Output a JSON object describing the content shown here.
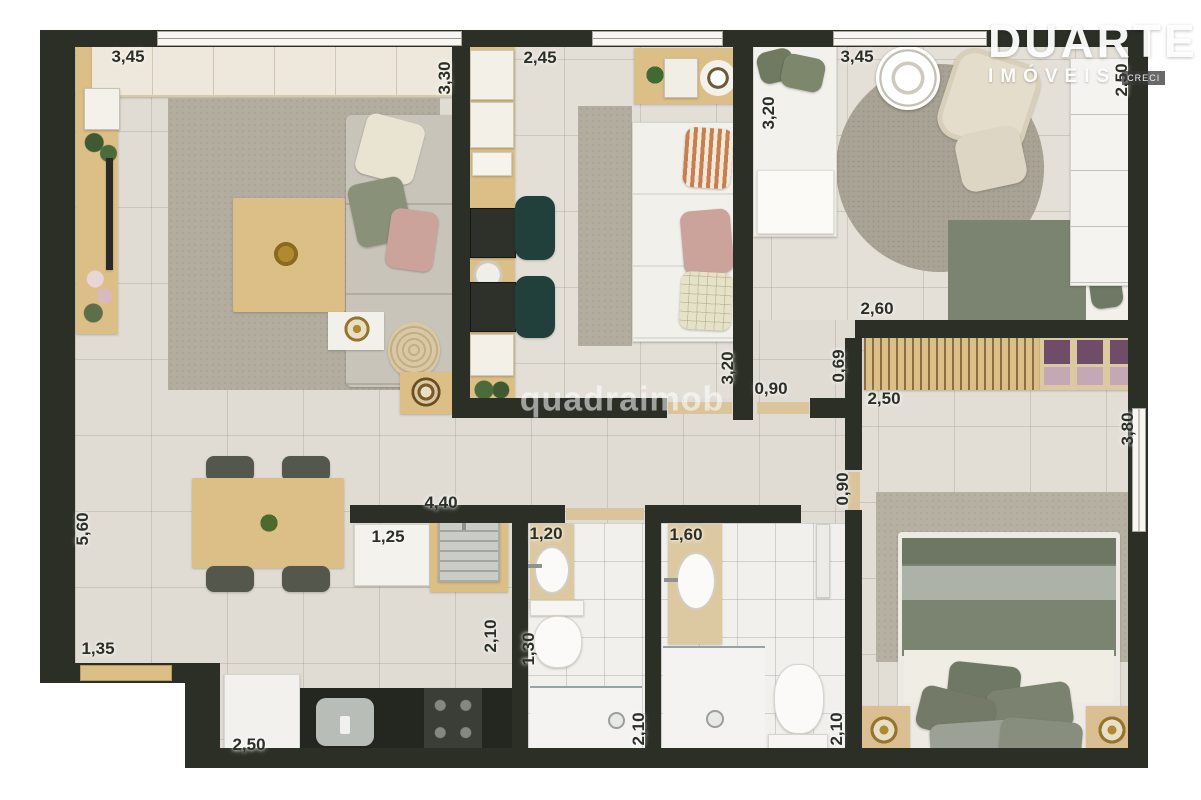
{
  "watermark": "quadraimob",
  "logo": {
    "name": "DUARTE",
    "subtitle": "IMÓVEIS",
    "badge": "CRECI"
  },
  "labels": [
    {
      "t": "3,45",
      "x": 128,
      "y": 57,
      "v": false
    },
    {
      "t": "3,30",
      "x": 445,
      "y": 78,
      "v": true
    },
    {
      "t": "2,45",
      "x": 540,
      "y": 58,
      "v": false
    },
    {
      "t": "3,20",
      "x": 769,
      "y": 113,
      "v": true
    },
    {
      "t": "3,45",
      "x": 857,
      "y": 57,
      "v": false
    },
    {
      "t": "2,50",
      "x": 1122,
      "y": 80,
      "v": true
    },
    {
      "t": "3,20",
      "x": 728,
      "y": 368,
      "v": true
    },
    {
      "t": "2,60",
      "x": 877,
      "y": 309,
      "v": false
    },
    {
      "t": "0,69",
      "x": 839,
      "y": 366,
      "v": true
    },
    {
      "t": "0,90",
      "x": 771,
      "y": 389,
      "v": false
    },
    {
      "t": "2,50",
      "x": 884,
      "y": 399,
      "v": false
    },
    {
      "t": "3,80",
      "x": 1128,
      "y": 429,
      "v": true
    },
    {
      "t": "0,90",
      "x": 843,
      "y": 489,
      "v": true
    },
    {
      "t": "5,60",
      "x": 83,
      "y": 529,
      "v": true
    },
    {
      "t": "4,40",
      "x": 441,
      "y": 503,
      "v": false
    },
    {
      "t": "1,25",
      "x": 388,
      "y": 537,
      "v": false
    },
    {
      "t": "1,20",
      "x": 546,
      "y": 534,
      "v": false
    },
    {
      "t": "1,60",
      "x": 686,
      "y": 535,
      "v": false
    },
    {
      "t": "2,10",
      "x": 491,
      "y": 636,
      "v": true
    },
    {
      "t": "1,30",
      "x": 529,
      "y": 649,
      "v": true
    },
    {
      "t": "1,35",
      "x": 98,
      "y": 649,
      "v": false
    },
    {
      "t": "2,50",
      "x": 249,
      "y": 745,
      "v": false
    },
    {
      "t": "2,10",
      "x": 639,
      "y": 729,
      "v": true
    },
    {
      "t": "2,10",
      "x": 837,
      "y": 729,
      "v": true
    }
  ],
  "colors": {
    "wall": "#2b2f25",
    "floor": "#e0dcd4",
    "bathfloor": "#f1f0ed",
    "wood": "#dcbf87",
    "tan": "#dcc9a2",
    "rug": "#b3ada0",
    "sofa": "#c9c4ba",
    "greenbed": "#7b8470",
    "sage": "#acb2a7",
    "pink": "#cba39a",
    "tealchair": "#21403b",
    "counter": "#23271f",
    "cream": "#f2f0ea",
    "purple": "#6f4c68"
  }
}
